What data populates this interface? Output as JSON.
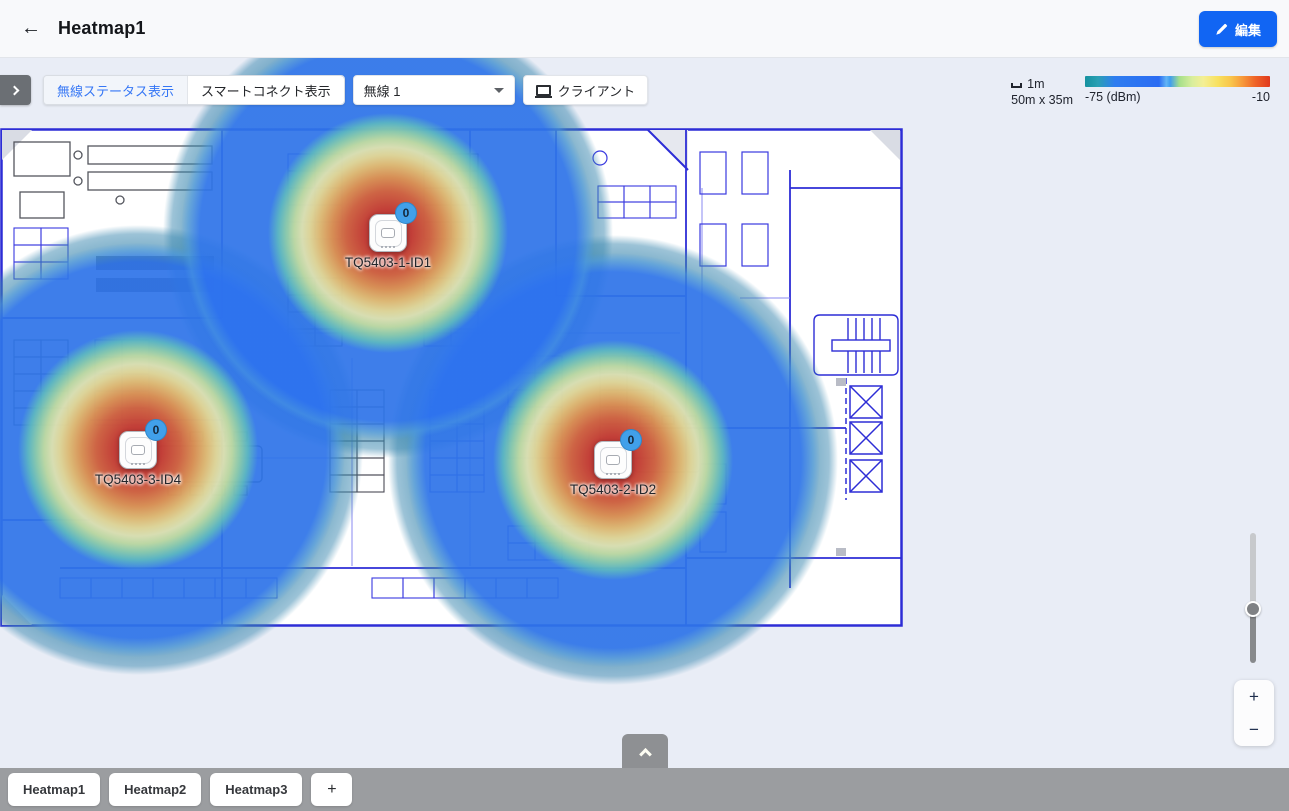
{
  "header": {
    "back_icon": "←",
    "title": "Heatmap1",
    "edit_label": "編集"
  },
  "toolbar": {
    "toggle_wireless_status": "無線ステータス表示",
    "toggle_smart_connect": "スマートコネクト表示",
    "radio_select_value": "無線 1",
    "client_label": "クライアント"
  },
  "legend": {
    "scale_label": "1m",
    "dimensions": "50m x 35m",
    "min_label": "-75 (dBm)",
    "max_label": "-10",
    "gradient": [
      {
        "color": "#15919f",
        "pos": 0
      },
      {
        "color": "#2aa0b4",
        "pos": 7
      },
      {
        "color": "#2e7df0",
        "pos": 16
      },
      {
        "color": "#2b6cf3",
        "pos": 40
      },
      {
        "color": "#63b5f5",
        "pos": 44
      },
      {
        "color": "#3f9df0",
        "pos": 46
      },
      {
        "color": "#a5df8a",
        "pos": 51
      },
      {
        "color": "#d9ee9c",
        "pos": 58
      },
      {
        "color": "#f4ef94",
        "pos": 64
      },
      {
        "color": "#f8e05e",
        "pos": 72
      },
      {
        "color": "#f9c44a",
        "pos": 79
      },
      {
        "color": "#f79a3a",
        "pos": 85
      },
      {
        "color": "#ef6428",
        "pos": 92
      },
      {
        "color": "#e0391d",
        "pos": 100
      }
    ]
  },
  "heatmap": {
    "aps": [
      {
        "name": "TQ5403-1-ID1",
        "clients": "0",
        "x": 388,
        "y": 175
      },
      {
        "name": "TQ5403-3-ID4",
        "clients": "0",
        "x": 138,
        "y": 392
      },
      {
        "name": "TQ5403-2-ID2",
        "clients": "0",
        "x": 613,
        "y": 402
      }
    ]
  },
  "zoom_controls": {
    "zoom_in": "+",
    "zoom_out": "−"
  },
  "tabs": {
    "items": [
      {
        "label": "Heatmap1"
      },
      {
        "label": "Heatmap2"
      },
      {
        "label": "Heatmap3"
      }
    ],
    "add_label": "+"
  }
}
